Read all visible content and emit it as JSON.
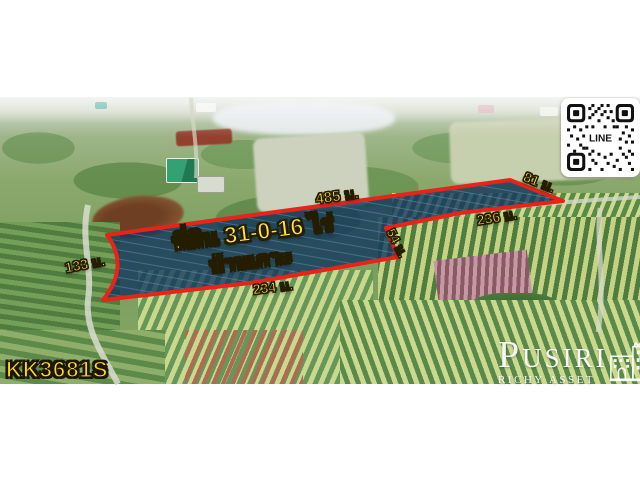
{
  "listing": {
    "title": "ที่ดิน 31-0-16 ไร่",
    "location": "บ้านเกาะ",
    "code": "KK3681S"
  },
  "dimensions": {
    "top": "485 ม.",
    "northeast": "81 ม.",
    "east": "236 ม.",
    "step": "54 ม.",
    "south": "234 ม.",
    "west": "133 ม."
  },
  "qr": {
    "label": "LINE"
  },
  "logo": {
    "name": "PUSIRI",
    "subtitle": "RICHY ASSET"
  },
  "colors": {
    "plot_outline": "#e8231a",
    "plot_fill": "#0d3461",
    "label_yellow": "#ffdf35"
  }
}
